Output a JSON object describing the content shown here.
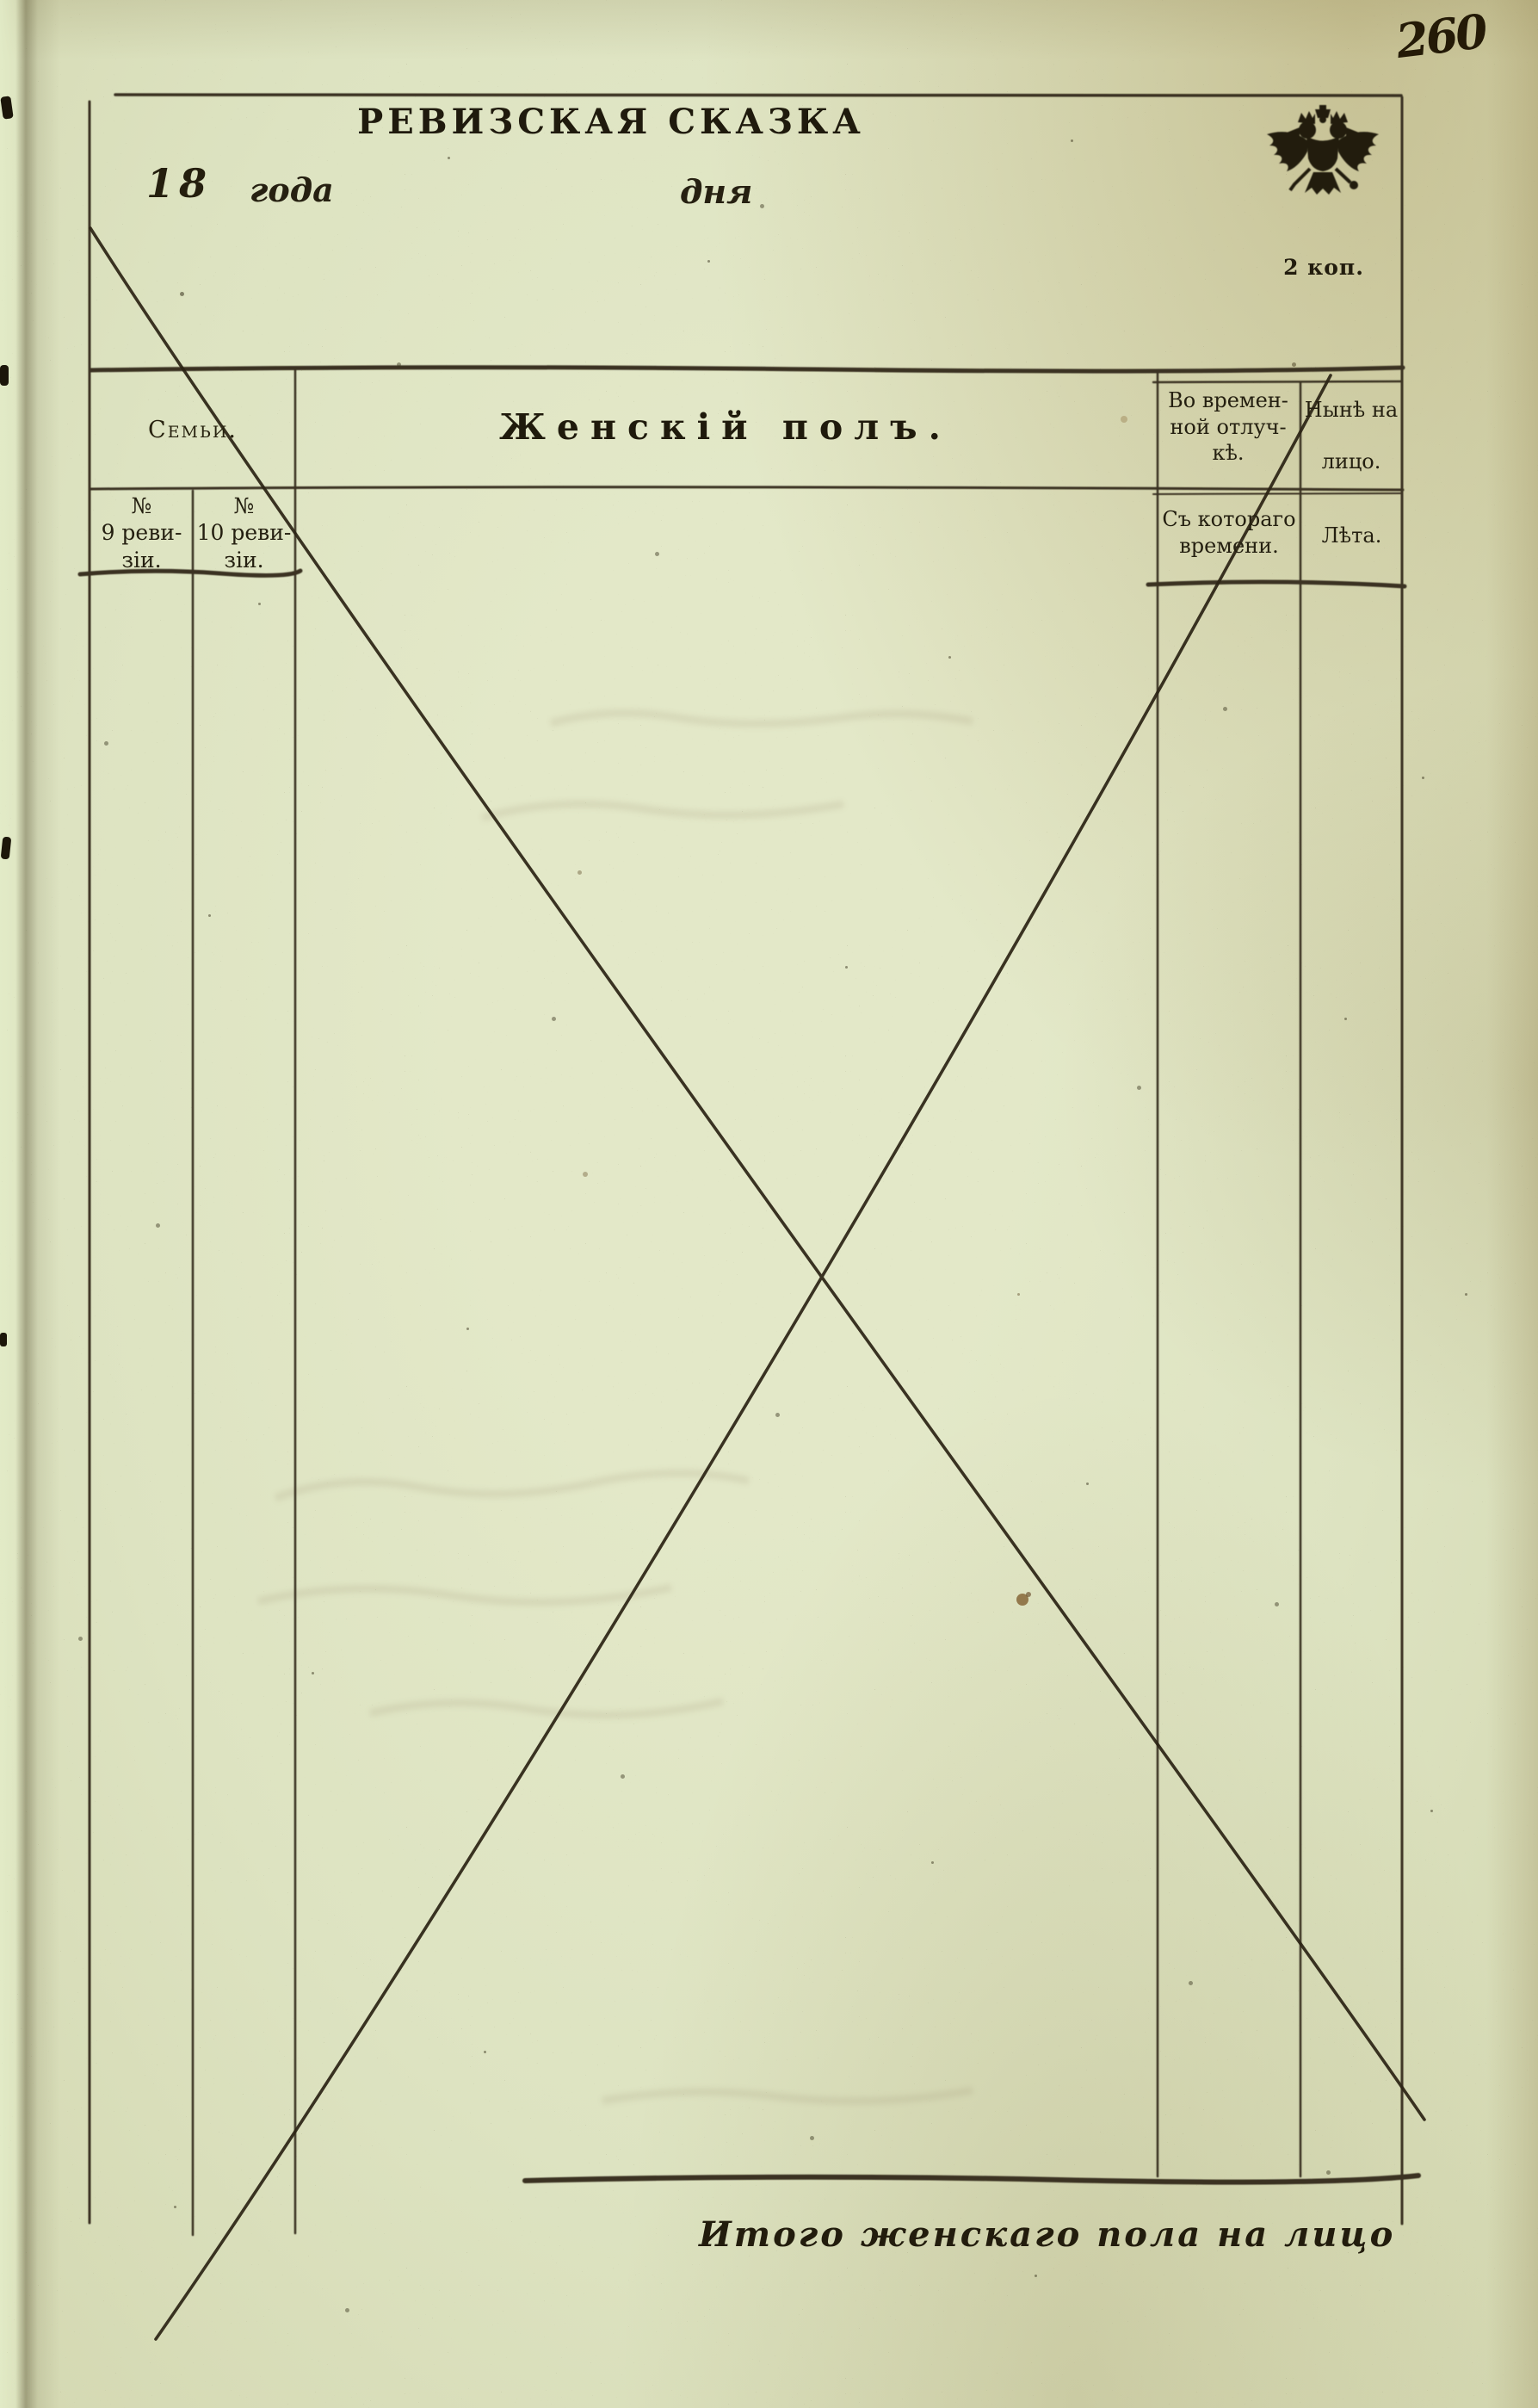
{
  "page": {
    "page_number": "260",
    "stamp_price": "2 коп."
  },
  "form_header": {
    "title": "РЕВИЗСКАЯ СКАЗКА",
    "year_prefix": "18",
    "year_word": "года",
    "day_word": "дня"
  },
  "table": {
    "col_families": "Семьи.",
    "col_female": "Женскій полъ.",
    "col_temp_absence": [
      "Во времен-",
      "ной отлуч-",
      "кѣ."
    ],
    "col_present": [
      "Нынѣ на",
      "лицо."
    ],
    "sub_rev9": [
      "№",
      "9 реви-",
      "зіи."
    ],
    "sub_rev10": [
      "№",
      "10 реви-",
      "зіи."
    ],
    "sub_since": [
      "Съ котораго",
      "времени."
    ],
    "sub_years": "Лѣта."
  },
  "footer": {
    "total_label": "Итого женскаго пола на лицо"
  },
  "colors": {
    "paper": "#dde3c1",
    "ink_print": "#231e10",
    "ink_lines": "#3a3322",
    "ink_handwriting": "#241a07",
    "stain": "#7a5526"
  }
}
